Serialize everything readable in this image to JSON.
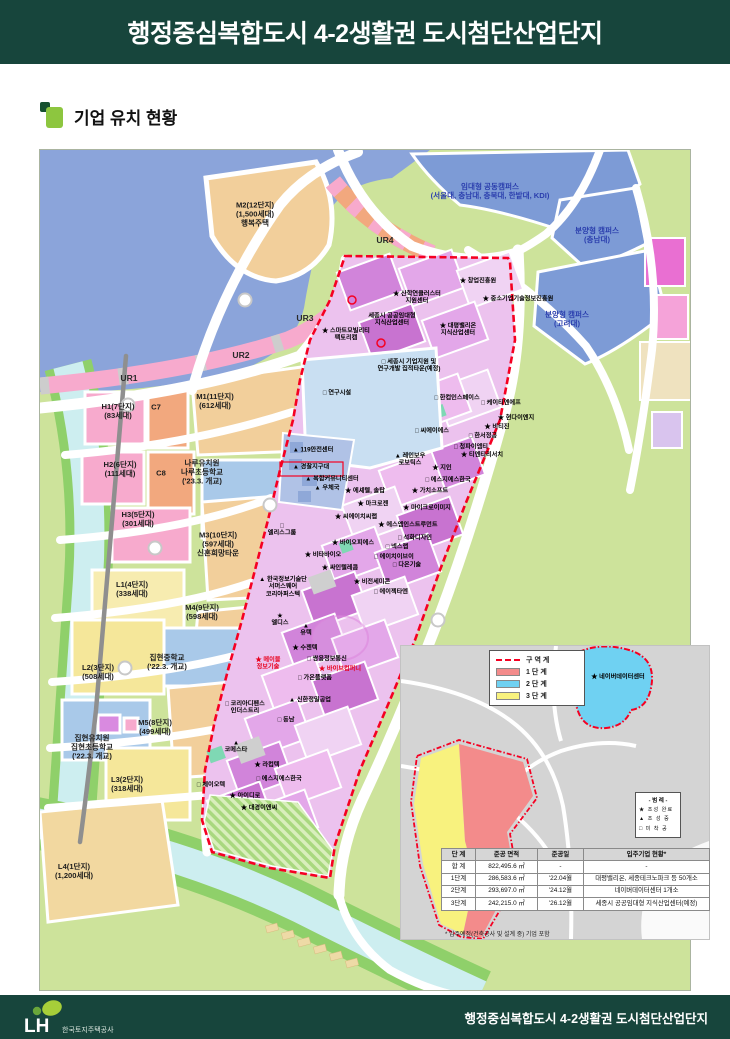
{
  "header": {
    "title": "행정중심복합도시 4-2생활권 도시첨단산업단지"
  },
  "section": {
    "title": "기업 유치 현황"
  },
  "colors": {
    "header_bg": "#17453c",
    "accent_light_green": "#8dc63f",
    "accent_dark_green": "#15502f",
    "boundary_red": "#f50022",
    "water_blue": "#8ba4da",
    "campus_blue": "#7d9bd6",
    "park_green": "#cde39b",
    "industrial_orchid": "#d184da",
    "residential_tan": "#f2cf9b",
    "residential_pink": "#f7aacd",
    "phase1_red": "#f38b8b",
    "phase2_blue": "#6fd1f2",
    "phase3_yellow": "#f8f27e"
  },
  "map": {
    "labels": [
      {
        "t": "M2(12단지)\n(1,500세대)\n행복주택",
        "x": 215,
        "y": 65,
        "c": "res"
      },
      {
        "t": "H1(7단지)\n(83세대)",
        "x": 78,
        "y": 262,
        "c": "res"
      },
      {
        "t": "C7",
        "x": 116,
        "y": 258,
        "c": "res"
      },
      {
        "t": "M1(11단지)\n(612세대)",
        "x": 175,
        "y": 252,
        "c": "res"
      },
      {
        "t": "H2(6단지)\n(111세대)",
        "x": 80,
        "y": 320,
        "c": "res"
      },
      {
        "t": "C8",
        "x": 121,
        "y": 324,
        "c": "res"
      },
      {
        "t": "나루유치원\n나루초등학교\n('23.3. 개교)",
        "x": 162,
        "y": 323,
        "c": "res"
      },
      {
        "t": "H3(5단지)\n(301세대)",
        "x": 98,
        "y": 370,
        "c": "res"
      },
      {
        "t": "M3(10단지)\n(597세대)\n신혼희망타운",
        "x": 178,
        "y": 395,
        "c": "res"
      },
      {
        "t": "L1(4단지)\n(338세대)",
        "x": 92,
        "y": 440,
        "c": "res"
      },
      {
        "t": "M4(9단지)\n(598세대)",
        "x": 162,
        "y": 463,
        "c": "res"
      },
      {
        "t": "집현중학교\n('22.3. 개교)",
        "x": 127,
        "y": 513,
        "c": "res"
      },
      {
        "t": "L2(3단지)\n(508세대)",
        "x": 58,
        "y": 523,
        "c": "res"
      },
      {
        "t": "M5(8단지)\n(499세대)",
        "x": 115,
        "y": 578,
        "c": "res"
      },
      {
        "t": "집현유치원\n집현초등학교\n('22.3. 개교)",
        "x": 52,
        "y": 598,
        "c": "res"
      },
      {
        "t": "L3(2단지)\n(318세대)",
        "x": 87,
        "y": 635,
        "c": "res"
      },
      {
        "t": "L4(1단지)\n(1,200세대)",
        "x": 34,
        "y": 722,
        "c": "res"
      },
      {
        "t": "UR4",
        "x": 345,
        "y": 90,
        "c": "ur"
      },
      {
        "t": "UR3",
        "x": 265,
        "y": 168,
        "c": "ur"
      },
      {
        "t": "UR2",
        "x": 201,
        "y": 205,
        "c": "ur"
      },
      {
        "t": "UR1",
        "x": 89,
        "y": 228,
        "c": "ur"
      },
      {
        "t": "임대형 공동캠퍼스\n(서울대, 충남대, 충북대, 한밭대, KDI)",
        "x": 450,
        "y": 42,
        "c": "blu"
      },
      {
        "t": "분양형 캠퍼스\n(충남대)",
        "x": 557,
        "y": 86,
        "c": "blu"
      },
      {
        "t": "분양형 캠퍼스\n(고려대)",
        "x": 527,
        "y": 170,
        "c": "blu"
      },
      {
        "t": "★ 창업진흥원",
        "x": 438,
        "y": 131,
        "c": "ind"
      },
      {
        "t": "★ 산학연클러스터\n지원센터",
        "x": 377,
        "y": 148,
        "c": "ind"
      },
      {
        "t": "★ 중소기업기술정보진흥원",
        "x": 478,
        "y": 149,
        "c": "ind"
      },
      {
        "t": "세종시 공공임대형\n지식산업센터",
        "x": 352,
        "y": 170,
        "c": "ind"
      },
      {
        "t": "★ 대평밸리온\n지식산업센터",
        "x": 418,
        "y": 180,
        "c": "ind"
      },
      {
        "t": "★ 스마트모빌리티\n팩토리캠",
        "x": 306,
        "y": 185,
        "c": "ind"
      },
      {
        "t": "□ 세종시 기업지원 및\n연구개발 집적타운(예정)",
        "x": 369,
        "y": 216,
        "c": "ind"
      },
      {
        "t": "□ 연구시설",
        "x": 297,
        "y": 243,
        "c": "ind"
      },
      {
        "t": "□ 한컴인스페이스",
        "x": 417,
        "y": 248,
        "c": "ind"
      },
      {
        "t": "□ 케이티엔에프",
        "x": 461,
        "y": 253,
        "c": "ind"
      },
      {
        "t": "★ 현다이엔지",
        "x": 476,
        "y": 268,
        "c": "ind"
      },
      {
        "t": "★ 비티진",
        "x": 457,
        "y": 277,
        "c": "ind"
      },
      {
        "t": "□ 씨에이에스",
        "x": 392,
        "y": 281,
        "c": "ind"
      },
      {
        "t": "□ 한서정공",
        "x": 443,
        "y": 286,
        "c": "ind"
      },
      {
        "t": "□ 청파이엠티",
        "x": 431,
        "y": 297,
        "c": "ind"
      },
      {
        "t": "★ 티엔티리서치",
        "x": 442,
        "y": 305,
        "c": "ind"
      },
      {
        "t": "▲ 119안전센터",
        "x": 273,
        "y": 300,
        "c": "ind"
      },
      {
        "t": "▲ 경찰지구대",
        "x": 271,
        "y": 317,
        "c": "ind"
      },
      {
        "t": "▲ 레인보우\n로보틱스",
        "x": 370,
        "y": 310,
        "c": "ind"
      },
      {
        "t": "★ 지인",
        "x": 402,
        "y": 318,
        "c": "ind"
      },
      {
        "t": "▲ 복합커뮤니티센터",
        "x": 292,
        "y": 329,
        "c": "ind"
      },
      {
        "t": "▲ 우체국",
        "x": 287,
        "y": 338,
        "c": "ind"
      },
      {
        "t": "★ 에셰텔, 솔탑",
        "x": 325,
        "y": 341,
        "c": "ind"
      },
      {
        "t": "□ 에스지에스한국",
        "x": 408,
        "y": 330,
        "c": "ind"
      },
      {
        "t": "★ 가치소프트",
        "x": 390,
        "y": 341,
        "c": "ind"
      },
      {
        "t": "★ 마크로젠",
        "x": 333,
        "y": 354,
        "c": "ind"
      },
      {
        "t": "★ 마이크로이미지",
        "x": 387,
        "y": 358,
        "c": "ind"
      },
      {
        "t": "★ 씨에이치씨랩",
        "x": 316,
        "y": 367,
        "c": "ind"
      },
      {
        "t": "★ 에스엠인스트루먼트",
        "x": 368,
        "y": 375,
        "c": "ind"
      },
      {
        "t": "□ 석화디자인",
        "x": 375,
        "y": 388,
        "c": "ind"
      },
      {
        "t": "★ 바이오피에스",
        "x": 313,
        "y": 393,
        "c": "ind"
      },
      {
        "t": "□ 넥스랩",
        "x": 357,
        "y": 397,
        "c": "ind"
      },
      {
        "t": "★ 비타바이오",
        "x": 283,
        "y": 405,
        "c": "ind"
      },
      {
        "t": "□ 에이치이브이",
        "x": 354,
        "y": 407,
        "c": "ind"
      },
      {
        "t": "★ 싸인텔레콤",
        "x": 300,
        "y": 418,
        "c": "ind"
      },
      {
        "t": "□ 다온기술",
        "x": 367,
        "y": 415,
        "c": "ind"
      },
      {
        "t": "★ 비전세미콘",
        "x": 332,
        "y": 432,
        "c": "ind"
      },
      {
        "t": "□ 에이젝타엔",
        "x": 351,
        "y": 442,
        "c": "ind"
      },
      {
        "t": "□\n엘리스그룹",
        "x": 242,
        "y": 380,
        "c": "ind"
      },
      {
        "t": "▲ 한국정보기술단\n서머스웨어\n코리아퍼스텍",
        "x": 243,
        "y": 437,
        "c": "ind"
      },
      {
        "t": "★\n엘디스",
        "x": 240,
        "y": 470,
        "c": "ind"
      },
      {
        "t": "▲\n유텍",
        "x": 266,
        "y": 480,
        "c": "ind"
      },
      {
        "t": "★ 수젠텍",
        "x": 265,
        "y": 498,
        "c": "ind"
      },
      {
        "t": "□ 쌍용정보통신",
        "x": 287,
        "y": 509,
        "c": "ind"
      },
      {
        "t": "★ 바이브컴퍼니",
        "x": 300,
        "y": 519,
        "c": "redl"
      },
      {
        "t": "★ 메이블\n정보기술",
        "x": 228,
        "y": 514,
        "c": "redl"
      },
      {
        "t": "□ 가온플랫폼",
        "x": 275,
        "y": 528,
        "c": "ind"
      },
      {
        "t": "▲ 신한정밀공업",
        "x": 270,
        "y": 550,
        "c": "ind"
      },
      {
        "t": "□ 동남",
        "x": 246,
        "y": 570,
        "c": "ind"
      },
      {
        "t": "□ 코리아디펜스\n인더스트리",
        "x": 205,
        "y": 558,
        "c": "ind"
      },
      {
        "t": "▲\n코메스타",
        "x": 196,
        "y": 597,
        "c": "ind"
      },
      {
        "t": "★ 라컴텍",
        "x": 227,
        "y": 615,
        "c": "ind"
      },
      {
        "t": "□ 제이오텍",
        "x": 171,
        "y": 635,
        "c": "ind"
      },
      {
        "t": "□ 에스지에스한국",
        "x": 239,
        "y": 629,
        "c": "ind"
      },
      {
        "t": "★ 아이디로",
        "x": 205,
        "y": 646,
        "c": "ind"
      },
      {
        "t": "★ 대경이앤씨",
        "x": 219,
        "y": 658,
        "c": "ind"
      },
      {
        "t": "★ 네이버데이터센터",
        "x": 578,
        "y": 527,
        "c": "ind"
      }
    ]
  },
  "inset": {
    "zone_legend": {
      "items": [
        {
          "label": "구역계",
          "type": "boundary-line"
        },
        {
          "label": "1단계",
          "color": "#f38b8b"
        },
        {
          "label": "2단계",
          "color": "#6fd1f2"
        },
        {
          "label": "3단계",
          "color": "#f8f27e"
        }
      ]
    },
    "marker_legend": {
      "title": "- 범 례 -",
      "items": [
        "★ 조성 완료",
        "▲ 조 성 중",
        "□ 미 착 공"
      ]
    },
    "table": {
      "headers": [
        "단 계",
        "준공 면적",
        "준공일",
        "입주기업 현황*"
      ],
      "rows": [
        [
          "합 계",
          "822,495.6 ㎡",
          "-",
          "-"
        ],
        [
          "1단계",
          "286,583.6 ㎡",
          "'22.04월",
          "대평밸리온, 세종테크노파크 등 50개소"
        ],
        [
          "2단계",
          "293,697.0 ㎡",
          "'24.12월",
          "네이버데이터센터 1개소"
        ],
        [
          "3단계",
          "242,215.0 ㎡",
          "'26.12월",
          "세종시 공공임대형 지식산업센터(예정)"
        ]
      ],
      "footnote": "* 입주예정(건축공사 및 설계 중) 기업 포함"
    }
  },
  "footer": {
    "logo": "LH",
    "logo_sub": "한국토지주택공사",
    "title": "행정중심복합도시 4-2생활권 도시첨단산업단지"
  }
}
